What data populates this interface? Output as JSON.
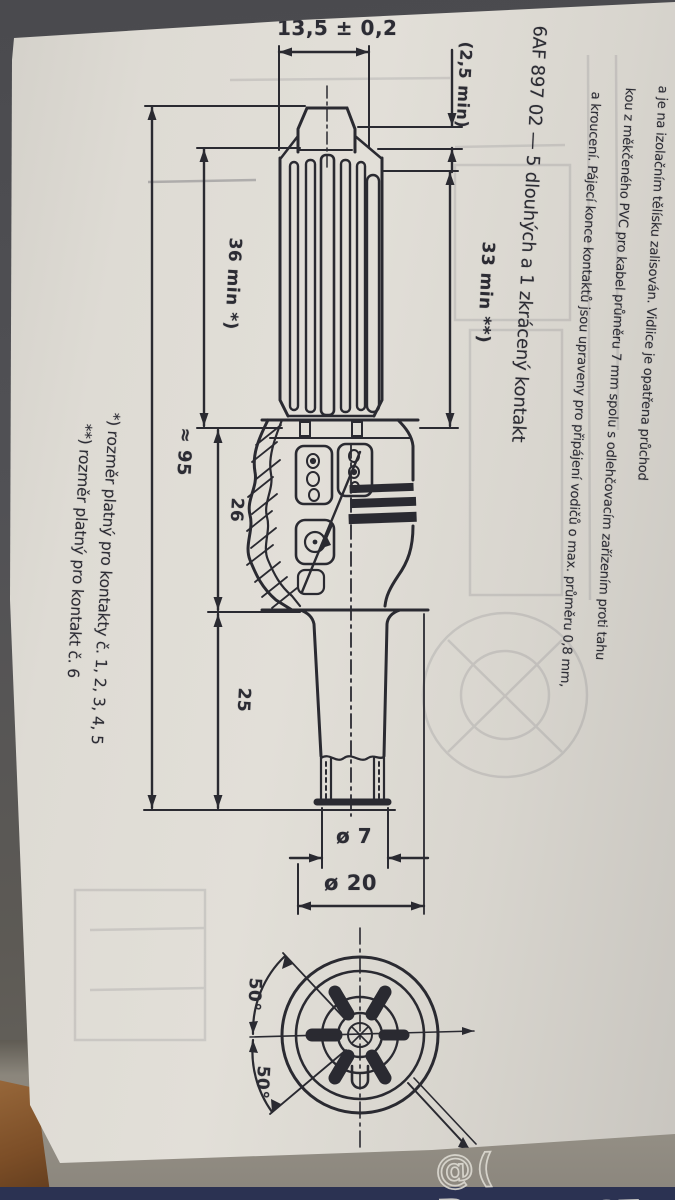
{
  "page": {
    "title": "6AF 897 02 — 5 dlouhých a 1 zkrácený kontakt",
    "paragraph": {
      "line1": "a je na izolačním tělísku zalisován. Vidlice je opatřena průchod",
      "line2": "kou z měkčeného PVC pro kabel průměru 7 mm spolu s odlehčovacím zařízením proti tahu",
      "line3": "a kroucení. Pájecí konce kontaktů jsou upraveny pro připájení vodičů o max. průměru 0,8 mm,"
    },
    "footnotes": {
      "note1": "*) rozměr platný pro kontakty č. 1, 2, 3, 4, 5",
      "note2": "**) rozměr platný pro kontakt č. 6"
    },
    "dimensions": {
      "width_tip": "13,5 ± 0,2",
      "tip_min": "(2,5 min)",
      "len_36": "36 min *)",
      "len_33": "33 min **)",
      "overall": "≈ 95",
      "len_26": "26",
      "len_25": "25",
      "dia_small": "ø 7",
      "dia_large": "ø 20",
      "angle_upper": "50°",
      "angle_lower": "50°"
    }
  },
  "watermark": {
    "text": "@( Bazos.cz"
  },
  "colors": {
    "ink": "#2a2a31",
    "paper": "#dcd9d2",
    "table": "#8f8a80",
    "bottom_strip": "#2b3252",
    "wood": "#8a5a34",
    "watermark_stroke": "#e6e3db"
  }
}
